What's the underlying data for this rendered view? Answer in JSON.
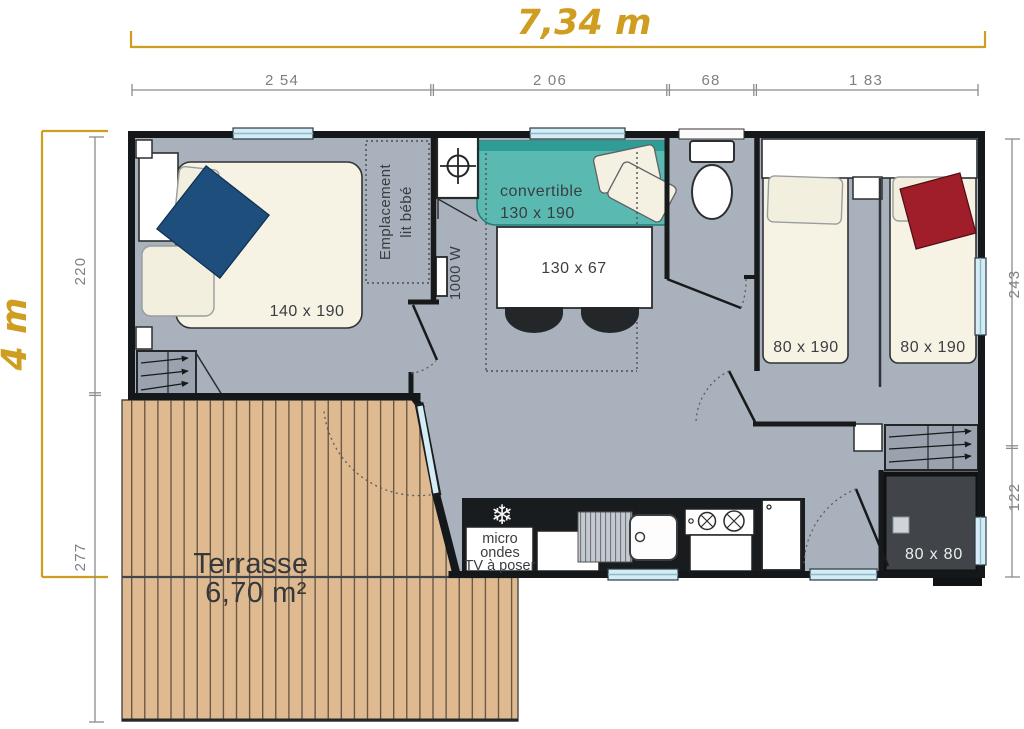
{
  "plan": {
    "overall": {
      "width_label": "7,34 m",
      "height_label": "4 m"
    },
    "dims": {
      "top": [
        "2 54",
        "2 06",
        "68",
        "1 83"
      ],
      "left": [
        "220",
        "277"
      ],
      "right": [
        "243",
        "122"
      ]
    },
    "bedroom_master": {
      "bed": "140 x 190",
      "baby1": "Emplacement",
      "baby2": "lit bébé"
    },
    "living": {
      "sofa1": "convertible",
      "sofa2": "130 x 190",
      "table": "130 x 67",
      "heater": "1000 W"
    },
    "bedroom_children": {
      "bed_left": "80 x 190",
      "bed_right": "80 x 190"
    },
    "bathroom": {
      "shower": "80 x 80"
    },
    "kitchen": {
      "l1": "micro",
      "l2": "ondes",
      "l3": "TV à poser"
    },
    "terrace": {
      "name": "Terrasse",
      "area": "6,70 m²"
    },
    "icons": {
      "freezer": "❄"
    }
  },
  "colors": {
    "accent_gold": "#cf9d1f",
    "dim_grey": "#7d8083",
    "wall": "#17191b",
    "floor": "#a9b1bc",
    "wood": "#dfba90",
    "sofa_teal": "#5ab9b1",
    "blanket_blue": "#1d4e7c",
    "blanket_red": "#a01d2a",
    "bed_cream": "#f6f2e4",
    "window_glass": "#d3ecf6",
    "shower_dark": "#41454a"
  }
}
